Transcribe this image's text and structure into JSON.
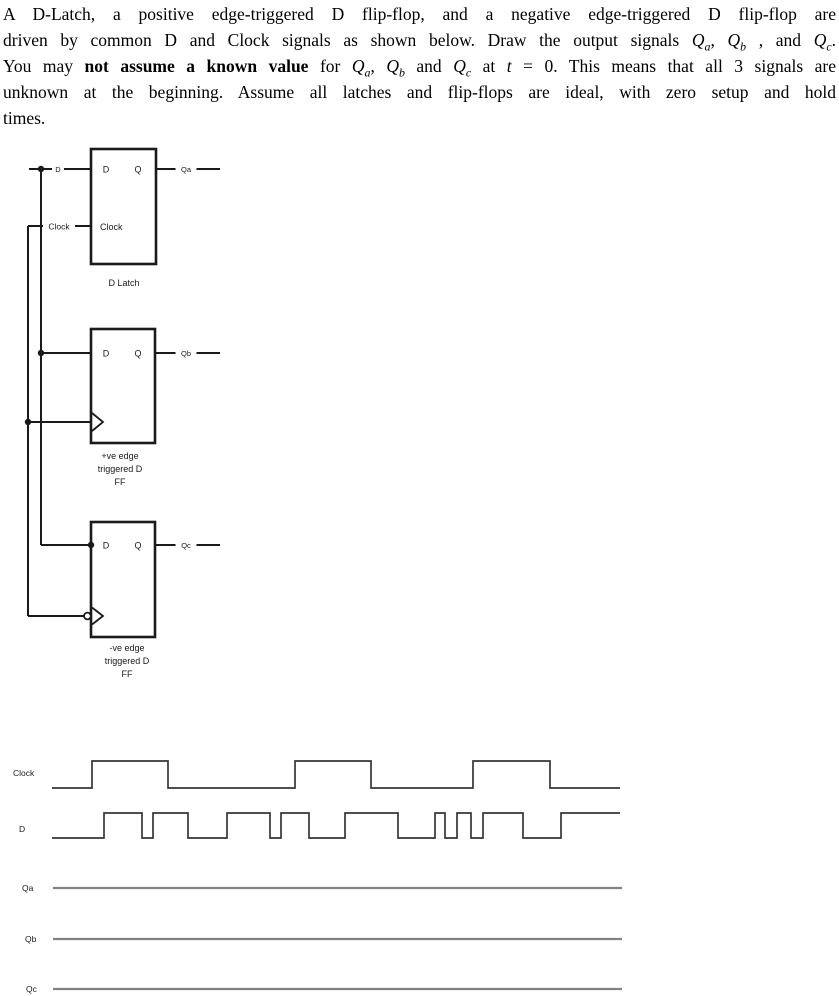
{
  "problem": {
    "lines": [
      {
        "segments": [
          {
            "t": "A D-Latch, a positive edge-triggered D flip-flop, and a negative edge-triggered D flip-flop are"
          }
        ]
      },
      {
        "segments": [
          {
            "t": "driven by common D and Clock signals as shown below. Draw the output signals "
          },
          {
            "t": "Q",
            "i": true
          },
          {
            "t": "a",
            "i": true,
            "sub": true
          },
          {
            "t": ", "
          },
          {
            "t": "Q",
            "i": true
          },
          {
            "t": "b",
            "i": true,
            "sub": true
          },
          {
            "t": " , and "
          },
          {
            "t": "Q",
            "i": true
          },
          {
            "t": "c",
            "i": true,
            "sub": true
          },
          {
            "t": "."
          }
        ]
      },
      {
        "segments": [
          {
            "t": "You may "
          },
          {
            "t": "not assume a known value",
            "b": true
          },
          {
            "t": " for "
          },
          {
            "t": "Q",
            "i": true
          },
          {
            "t": "a",
            "i": true,
            "sub": true
          },
          {
            "t": ", "
          },
          {
            "t": "Q",
            "i": true
          },
          {
            "t": "b",
            "i": true,
            "sub": true
          },
          {
            "t": " and "
          },
          {
            "t": "Q",
            "i": true
          },
          {
            "t": "c",
            "i": true,
            "sub": true
          },
          {
            "t": " at "
          },
          {
            "t": "t",
            "i": true
          },
          {
            "t": " = 0. This means that all 3 signals are"
          }
        ]
      },
      {
        "segments": [
          {
            "t": "unknown at the beginning.  Assume all latches and flip-flops are ideal, with zero setup and hold"
          }
        ]
      },
      {
        "segments": [
          {
            "t": "times."
          }
        ],
        "last": true
      }
    ]
  },
  "circuit": {
    "d_wire_label": "D",
    "clock_wire_label": "Clock",
    "blocks": [
      {
        "id": "d-latch",
        "pin_d": "D",
        "pin_q": "Q",
        "pin_clock": "Clock",
        "output_label": "Qa",
        "caption": [
          "D Latch"
        ],
        "clock_kind": "level"
      },
      {
        "id": "pos-edge-dff",
        "pin_d": "D",
        "pin_q": "Q",
        "output_label": "Qb",
        "caption": [
          "+ve edge",
          "triggered D",
          "FF"
        ],
        "clock_kind": "pos-edge"
      },
      {
        "id": "neg-edge-dff",
        "pin_d": "D",
        "pin_q": "Q",
        "output_label": "Qc",
        "caption": [
          "-ve edge",
          "triggered D",
          "FF"
        ],
        "clock_kind": "neg-edge"
      }
    ]
  },
  "timing": {
    "x_start": 52,
    "x_end": 620,
    "rows": [
      {
        "label": "Clock",
        "type": "signal",
        "start_level": 0,
        "toggles": [
          92,
          168,
          295,
          371,
          473,
          550
        ],
        "high_y": 761,
        "low_y": 788,
        "label_pos": [
          13,
          776
        ]
      },
      {
        "label": "D",
        "type": "signal",
        "start_level": 0,
        "toggles": [
          104,
          142,
          153,
          188,
          227,
          270,
          281,
          309,
          345,
          398,
          435,
          445,
          457,
          471,
          483,
          523,
          561
        ],
        "high_y": 813,
        "low_y": 838,
        "label_pos": [
          19,
          832
        ]
      },
      {
        "label": "Qa",
        "type": "blank",
        "y": 888,
        "x1": 53,
        "x2": 622,
        "label_pos": [
          22,
          891
        ]
      },
      {
        "label": "Qb",
        "type": "blank",
        "y": 939,
        "x1": 53,
        "x2": 622,
        "label_pos": [
          25,
          942
        ]
      },
      {
        "label": "Qc",
        "type": "blank",
        "y": 989,
        "x1": 53,
        "x2": 622,
        "label_pos": [
          26,
          992
        ]
      }
    ]
  },
  "colors": {
    "ink": "#1a1a1a",
    "waveform": "#363636",
    "answer_line": "#828282",
    "paper": "#ffffff"
  }
}
